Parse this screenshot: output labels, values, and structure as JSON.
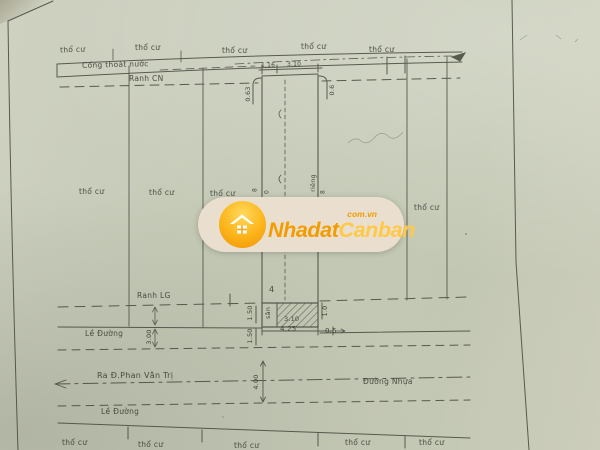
{
  "watermark": {
    "brand_part1": "Nhadat",
    "brand_part2": "Canban",
    "domain": "com.vn",
    "colors": {
      "brand_orange": "#f39c00",
      "brand_yellow": "#ffc947",
      "pill_background": "#eadfce",
      "circle_gradient_top": "#ffd95c",
      "circle_gradient_bottom": "#ef9307"
    },
    "icon": "house-icon"
  },
  "drawing": {
    "paper_color": "#c8ccba",
    "ink_color": "#4b4e42",
    "parcel_label": "thổ cư",
    "labels": {
      "drain": "Cống thoát nước",
      "ranh_cn": "Ranh CN",
      "ranh_lg": "Ranh LG",
      "road_shoulder": "Lề Đường",
      "to_street": "Ra Đ.Phan Văn Trị",
      "asphalt_road": "Đường Nhựa",
      "yard": "sân",
      "wall": "riêng"
    },
    "dimensions": {
      "top_seg_a": "1.16",
      "top_seg_b": "3.10",
      "offset_left": "0.63",
      "offset_right": "0.6",
      "house_width": "3.10",
      "frontage": "4.25",
      "right_gap": "0.5",
      "right_depth": "1.0",
      "gap_upper": "1.50",
      "gap_lower": "1.50",
      "shoulder_width": "3.00",
      "road_width": "4.00",
      "mark_left_outer": "8",
      "mark_left_inner": "0",
      "mark_right_inner": "8",
      "center_mark": "4"
    }
  }
}
